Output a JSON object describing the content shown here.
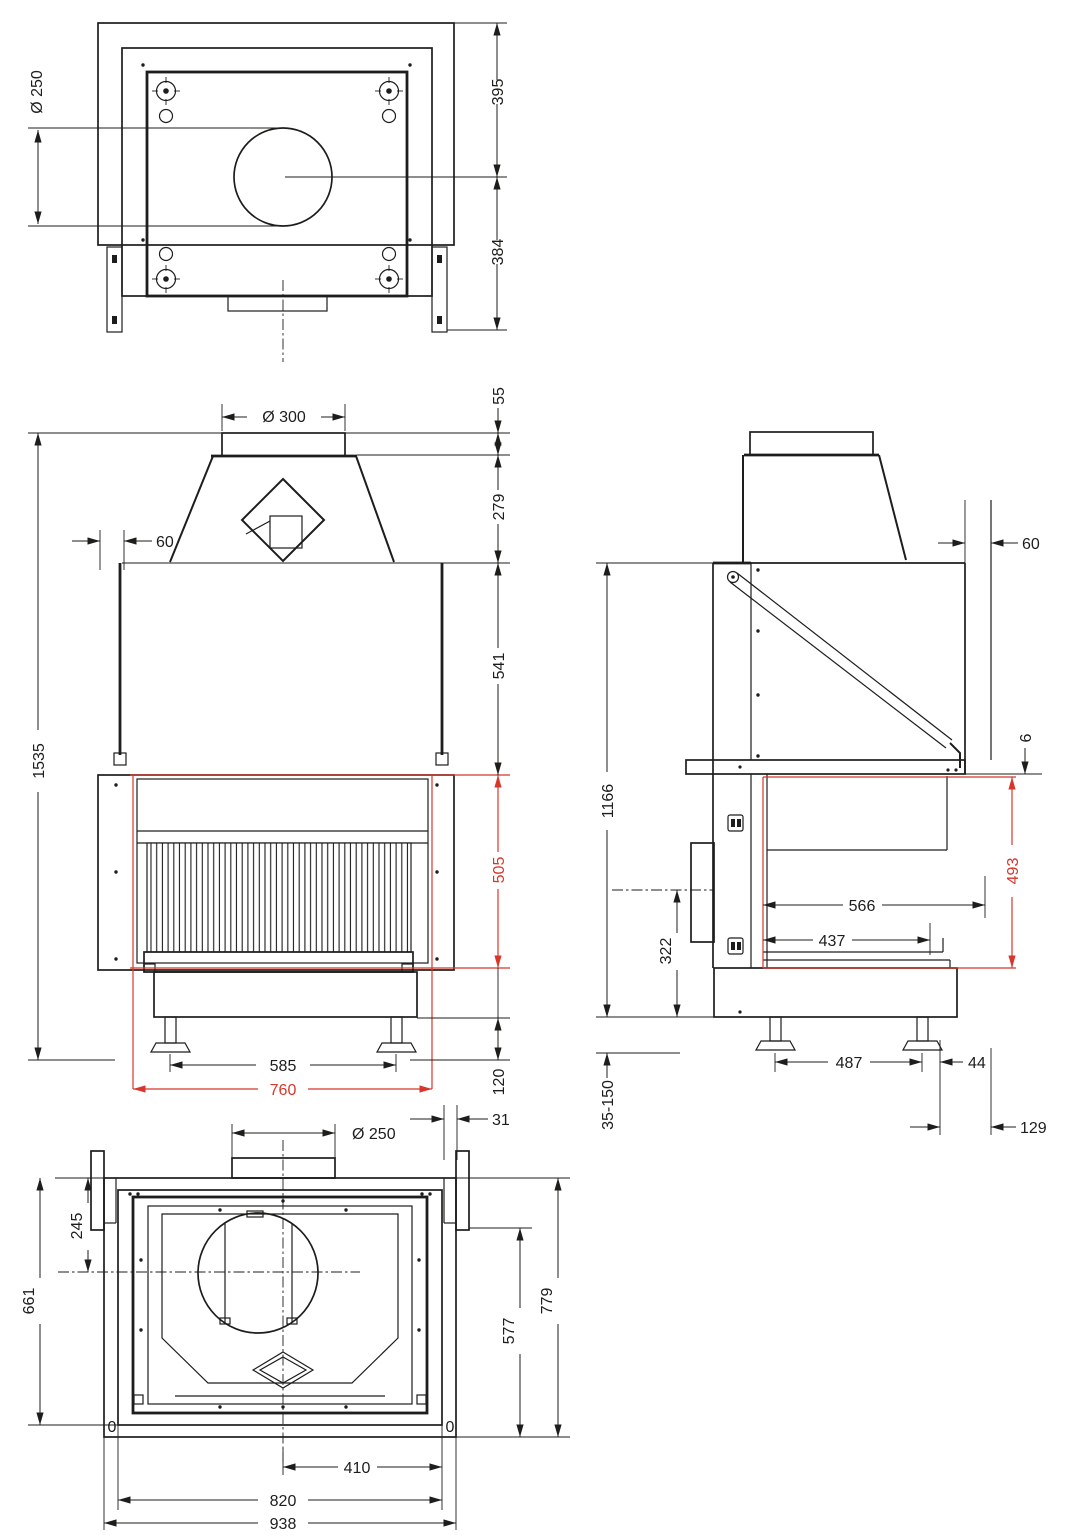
{
  "drawing": {
    "kind": "technical-drawing",
    "subject": "fireplace insert — four orthographic views with dimensions in mm",
    "units": "mm",
    "colors": {
      "line": "#1d1d1b",
      "accent_red": "#d8362a",
      "background": "#ffffff"
    },
    "views": {
      "top": {
        "name": "top view",
        "dims": {
          "dia250": "Ø 250",
          "h395": "395",
          "h384": "384"
        }
      },
      "front": {
        "name": "front view",
        "dims": {
          "dia300": "Ø 300",
          "off60": "60",
          "h55": "55",
          "h279": "279",
          "h541": "541",
          "h505": "505",
          "h120": "120",
          "h1535": "1535",
          "w585": "585",
          "w760": "760"
        }
      },
      "side": {
        "name": "side view",
        "dims": {
          "off60": "60",
          "g6": "6",
          "h1166": "1166",
          "h493": "493",
          "d566": "566",
          "d437": "437",
          "h322": "322",
          "w487": "487",
          "w44": "44",
          "w129": "129",
          "feet": "35-150"
        }
      },
      "bottom": {
        "name": "bottom view",
        "dims": {
          "dia250": "Ø 250",
          "w31": "31",
          "h245": "245",
          "h661": "661",
          "h779": "779",
          "h577": "577",
          "w410": "410",
          "w820": "820",
          "w938": "938",
          "zero_left": "0",
          "zero_right": "0"
        }
      }
    }
  }
}
